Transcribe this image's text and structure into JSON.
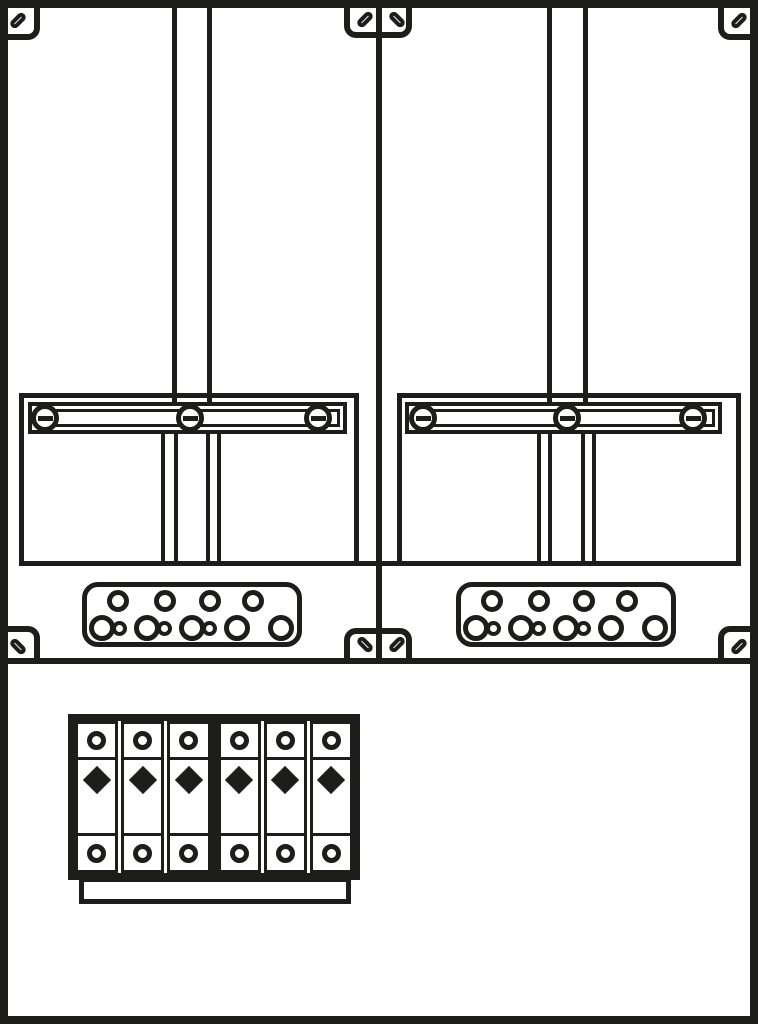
{
  "diagram": {
    "kind": "meter-cabinet-panel-drawing",
    "description": "Two-field meter cabinet line diagram with mounting rails, screw cross bars, cable gland plates and a six-module breaker block",
    "line_color": "#1d1d1b",
    "background_color": "#ffffff",
    "width": 758,
    "height": 1024
  },
  "cabinet": {
    "frame_border_px": 8,
    "divider": {
      "x": 376,
      "width": 6,
      "top": 0,
      "height": 661
    },
    "band": {
      "top_line": {
        "x": 19,
        "y": 561,
        "w": 722,
        "h": 5
      },
      "bottom_line": {
        "x": 8,
        "y": 658,
        "w": 742,
        "h": 6
      }
    },
    "panels": [
      {
        "side": "left",
        "rails": {
          "xs": [
            172,
            207
          ],
          "width": 5,
          "top": 8,
          "bottom": 408
        },
        "sub_rails": {
          "xs": [
            161,
            174,
            206,
            217
          ],
          "width": 4,
          "top": 434,
          "bottom": 566
        },
        "plate": {
          "x": 19,
          "y": 393,
          "w": 340,
          "h": 173
        },
        "bar": {
          "x": 28,
          "y": 402,
          "w": 319,
          "h": 32,
          "inner_inset": 7,
          "screw_xs": [
            45,
            190,
            318
          ],
          "screw_y": 418
        },
        "gland_plate": {
          "x": 82,
          "y": 582,
          "w": 220,
          "h": 65,
          "radius": 16,
          "top_holes": {
            "xs": [
              118,
              165,
              210,
              253
            ],
            "y": 601,
            "d": 22
          },
          "bottom_holes": {
            "y": 628,
            "items": [
              {
                "x": 102,
                "d": 26
              },
              {
                "x": 119,
                "d": 15
              },
              {
                "x": 147,
                "d": 26
              },
              {
                "x": 164,
                "d": 15
              },
              {
                "x": 192,
                "d": 26
              },
              {
                "x": 209,
                "d": 15
              },
              {
                "x": 237,
                "d": 26
              },
              {
                "x": 281,
                "d": 26
              }
            ]
          }
        }
      },
      {
        "side": "right",
        "rails": {
          "xs": [
            547,
            583
          ],
          "width": 5,
          "top": 8,
          "bottom": 408
        },
        "sub_rails": {
          "xs": [
            537,
            548,
            581,
            592
          ],
          "width": 4,
          "top": 434,
          "bottom": 566
        },
        "plate": {
          "x": 397,
          "y": 393,
          "w": 344,
          "h": 173
        },
        "bar": {
          "x": 405,
          "y": 402,
          "w": 317,
          "h": 32,
          "inner_inset": 7,
          "screw_xs": [
            423,
            567,
            693
          ],
          "screw_y": 418
        },
        "gland_plate": {
          "x": 456,
          "y": 582,
          "w": 220,
          "h": 65,
          "radius": 16,
          "top_holes": {
            "xs": [
              492,
              539,
              584,
              627
            ],
            "y": 601,
            "d": 22
          },
          "bottom_holes": {
            "y": 628,
            "items": [
              {
                "x": 476,
                "d": 26
              },
              {
                "x": 493,
                "d": 15
              },
              {
                "x": 521,
                "d": 26
              },
              {
                "x": 538,
                "d": 15
              },
              {
                "x": 566,
                "d": 26
              },
              {
                "x": 583,
                "d": 15
              },
              {
                "x": 611,
                "d": 26
              },
              {
                "x": 655,
                "d": 26
              }
            ]
          }
        }
      }
    ],
    "fasteners": {
      "corner_slot_count": 8,
      "locations": [
        "top-left",
        "top-center-left",
        "top-center-right",
        "top-right",
        "mid-left",
        "mid-center-left",
        "mid-center-right",
        "mid-right"
      ]
    },
    "breaker_block": {
      "x": 68,
      "y": 714,
      "w": 292,
      "h": 166,
      "module_count": 6,
      "groups": [
        3,
        3
      ],
      "module_symbols": {
        "top": "terminal-circle",
        "middle": "diamond-indicator",
        "bottom": "terminal-circle"
      },
      "base": {
        "x": 79,
        "y": 877,
        "w": 272,
        "h": 27
      }
    }
  }
}
